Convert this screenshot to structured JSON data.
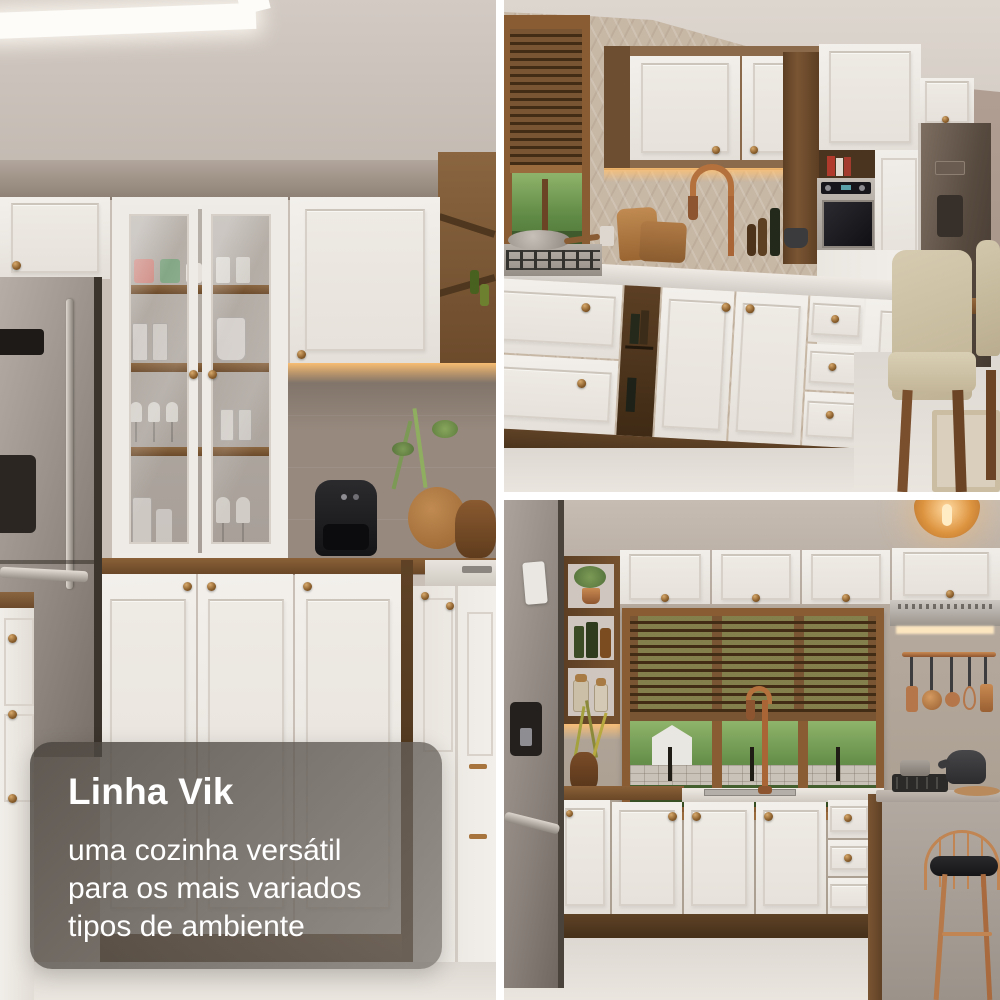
{
  "caption": {
    "title": "Linha Vik",
    "line1": "uma cozinha versátil",
    "line2": "para os mais variados",
    "line3": "tipos de ambiente"
  },
  "photos": {
    "left": {
      "alt": "Cozinha com cristaleira de portas de vidro, armários brancos, geladeira inox e air fryer na bancada"
    },
    "top_right": {
      "alt": "Cozinha com armários brancos e madeira, forno embutido, cooktop, janela com persiana e cadeiras de jantar"
    },
    "bottom_right": {
      "alt": "Cozinha com janela de persiana de madeira, torneira cobre, coifa, ilha de concreto e banqueta"
    }
  },
  "colors": {
    "caption_bg": "#6f6a64",
    "caption_text": "#ffffff",
    "cabinet_white": "#efece7",
    "wood": "#7b5836",
    "copper_accent": "#b5774a",
    "gutter": "#ffffff"
  }
}
